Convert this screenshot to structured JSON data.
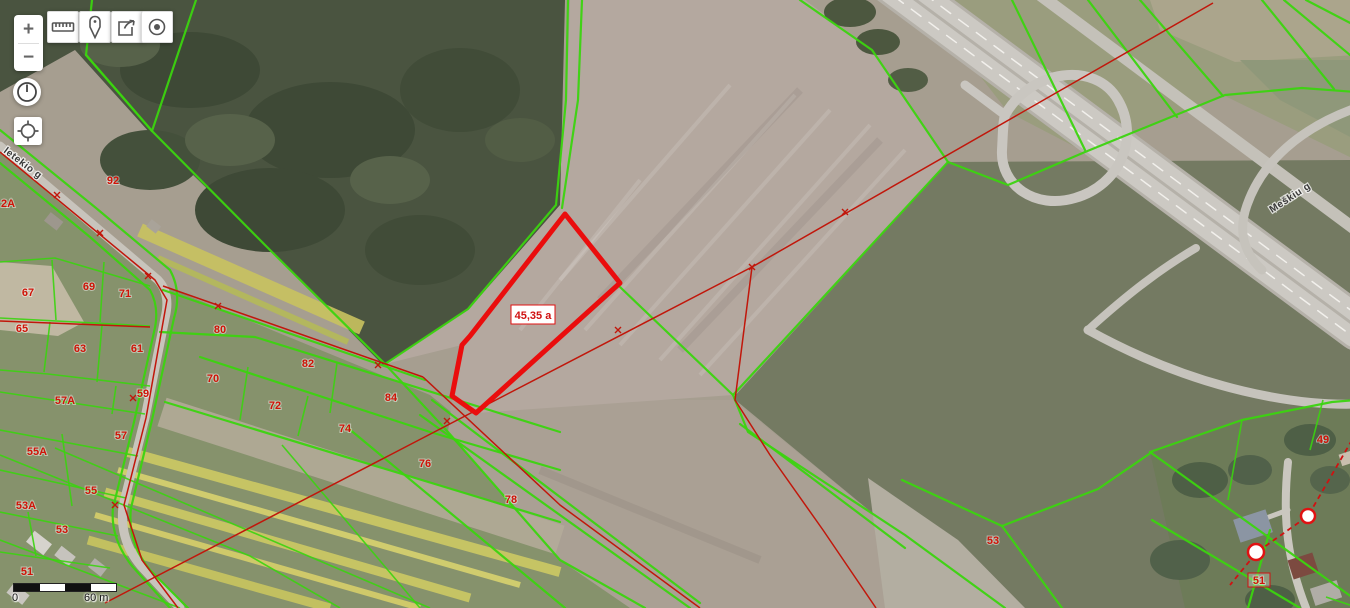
{
  "toolbar": {
    "zoom_in_label": "+",
    "zoom_out_label": "−",
    "buttons": [
      {
        "icon": "ruler-icon"
      },
      {
        "icon": "pin-icon"
      },
      {
        "icon": "export-icon"
      },
      {
        "icon": "target-icon"
      }
    ]
  },
  "side_controls": [
    {
      "icon": "clock-icon"
    },
    {
      "icon": "crosshair-icon"
    }
  ],
  "scale_bar": {
    "zero_label": "0",
    "distance_label": "60 m"
  },
  "map": {
    "highlight": {
      "area_label": "45,35 a"
    },
    "street_labels": [
      {
        "text": "letekio g",
        "x": 3,
        "y": 152,
        "rotate": 37
      },
      {
        "text": "Meškiu g",
        "x": 1272,
        "y": 213,
        "rotate": -33
      }
    ],
    "parcel_labels": [
      {
        "text": "2A",
        "x": 8,
        "y": 207
      },
      {
        "text": "92",
        "x": 113,
        "y": 184
      },
      {
        "text": "67",
        "x": 28,
        "y": 296
      },
      {
        "text": "69",
        "x": 89,
        "y": 290
      },
      {
        "text": "71",
        "x": 125,
        "y": 297
      },
      {
        "text": "65",
        "x": 22,
        "y": 332
      },
      {
        "text": "80",
        "x": 220,
        "y": 333
      },
      {
        "text": "63",
        "x": 80,
        "y": 352
      },
      {
        "text": "61",
        "x": 137,
        "y": 352
      },
      {
        "text": "82",
        "x": 308,
        "y": 367
      },
      {
        "text": "70",
        "x": 213,
        "y": 382
      },
      {
        "text": "59",
        "x": 143,
        "y": 397
      },
      {
        "text": "57A",
        "x": 65,
        "y": 404
      },
      {
        "text": "84",
        "x": 391,
        "y": 401
      },
      {
        "text": "72",
        "x": 275,
        "y": 409
      },
      {
        "text": "74",
        "x": 345,
        "y": 432
      },
      {
        "text": "57",
        "x": 121,
        "y": 439
      },
      {
        "text": "55A",
        "x": 37,
        "y": 455
      },
      {
        "text": "76",
        "x": 425,
        "y": 467
      },
      {
        "text": "55",
        "x": 91,
        "y": 494
      },
      {
        "text": "78",
        "x": 511,
        "y": 503
      },
      {
        "text": "53A",
        "x": 26,
        "y": 509
      },
      {
        "text": "53",
        "x": 62,
        "y": 533
      },
      {
        "text": "51",
        "x": 27,
        "y": 575
      },
      {
        "text": "53",
        "x": 993,
        "y": 544
      },
      {
        "text": "49",
        "x": 1323,
        "y": 443
      },
      {
        "text": "51",
        "x": 1259,
        "y": 584,
        "boxed": true
      }
    ],
    "colors": {
      "cadastral_green": "#3bd40f",
      "cadastral_red": "#c1170b",
      "highlight_red": "#ea0d0d",
      "label_red": "#cf1408"
    }
  }
}
